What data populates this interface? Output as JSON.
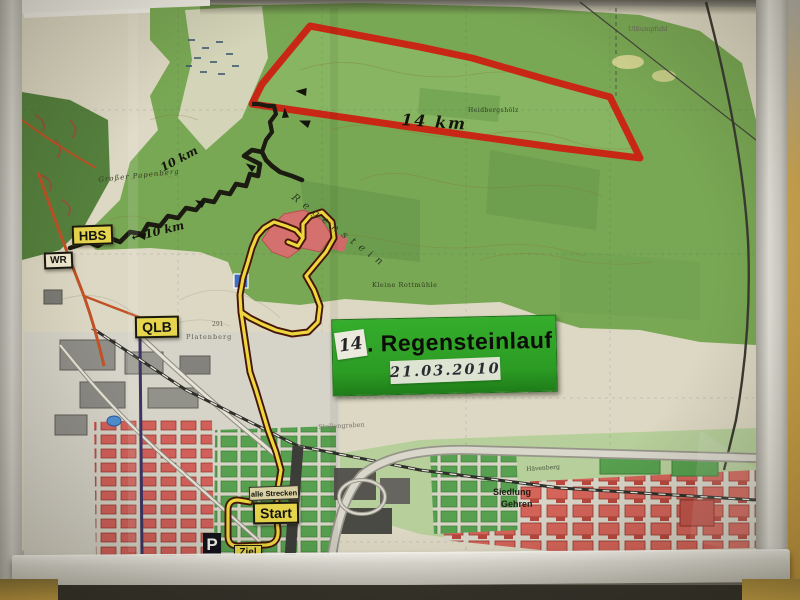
{
  "signs": {
    "hbs_label": "HBS",
    "wr_label": "WR",
    "qlb_label": "QLB",
    "alle_strecken_label": "alle Strecken",
    "start_label": "Start",
    "ziel_label": "Ziel",
    "parking_label": "P"
  },
  "event_sign": {
    "number": "14",
    "title_suffix": ". Regensteinlauf",
    "date": "21.03.2010",
    "bg_color": "#2c9c24"
  },
  "route_labels": {
    "red_distance": "14 km",
    "black_distance_upper": "10 km",
    "black_distance_lower": "← 10 km"
  },
  "map_labels": {
    "papenberg": "Großer Papenberg",
    "regenstein": "Regenstein",
    "rottmuehle": "Kleine Rottmühle",
    "ulsumpfuhl": "Ulßumpfuhl",
    "heidholz": "Heidbergshölz",
    "platenberg": "Platenberg",
    "elevation": "291",
    "stollengraben": "Stollengraben",
    "siedlung_line1": "Siedlung",
    "siedlung_line2": "Gehren",
    "haevenberg": "Hävenberg"
  },
  "legend_colors": {
    "route_14km_red": "#c82715",
    "route_10km_black": "#1b1b12",
    "route_common_yellow": "#ecd73e",
    "forest_green": "#79a854",
    "urban_red": "#d5645a",
    "sign_yellow": "#e6d54c"
  }
}
